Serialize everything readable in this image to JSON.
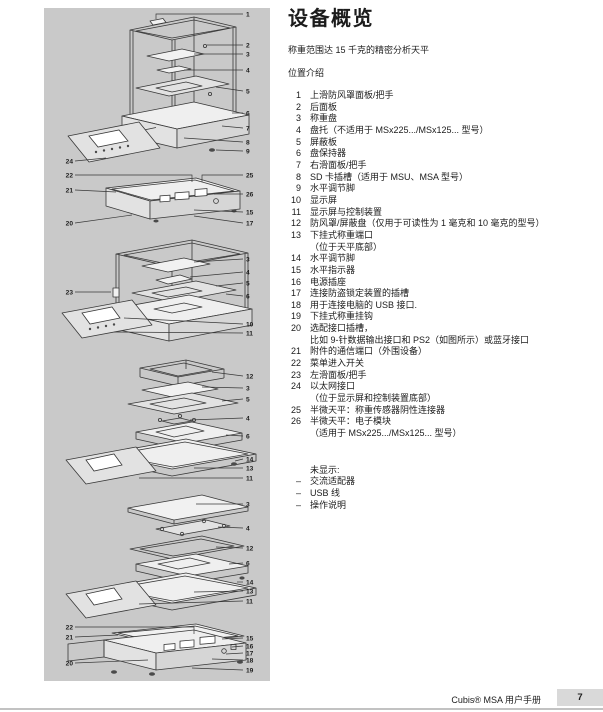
{
  "header": {
    "title": "设备概览",
    "subtitle": "称重范围达 15 千克的精密分析天平",
    "section_label": "位置介绍"
  },
  "parts_list": {
    "lines": [
      {
        "no": "1",
        "text": "上滑防风罩面板/把手"
      },
      {
        "no": "2",
        "text": "后面板"
      },
      {
        "no": "3",
        "text": "称重盘"
      },
      {
        "no": "4",
        "text": "盘托（不适用于 MSx225.../MSx125... 型号）"
      },
      {
        "no": "5",
        "text": "屏蔽板"
      },
      {
        "no": "6",
        "text": "盘保持器"
      },
      {
        "no": "7",
        "text": "右滑面板/把手"
      },
      {
        "no": "8",
        "text": "SD 卡插槽（适用于 MSU、MSA 型号）"
      },
      {
        "no": "9",
        "text": "水平调节脚"
      },
      {
        "no": "10",
        "text": "显示屏"
      },
      {
        "no": "11",
        "text": "显示屏与控制装置"
      },
      {
        "no": "12",
        "text": "防风罩/屏蔽盘（仅用于可读性为 1 毫克和 10 毫克的型号）"
      },
      {
        "no": "13",
        "text": "下挂式称重端口"
      },
      {
        "no": "",
        "text": "（位于天平底部）"
      },
      {
        "no": "14",
        "text": "水平调节脚"
      },
      {
        "no": "15",
        "text": "水平指示器"
      },
      {
        "no": "16",
        "text": "电源插座"
      },
      {
        "no": "17",
        "text": "连接防盗锁定装置的插槽"
      },
      {
        "no": "18",
        "text": "用于连接电脑的 USB 接口."
      },
      {
        "no": "19",
        "text": "下挂式称重挂钩"
      },
      {
        "no": "20",
        "text": "选配接口插槽，"
      },
      {
        "no": "",
        "text": "比如 9-针数据输出接口和 PS2（如图所示）或蓝牙接口"
      },
      {
        "no": "21",
        "text": "附件的通信端口（外围设备）"
      },
      {
        "no": "22",
        "text": "菜单进入开关"
      },
      {
        "no": "23",
        "text": "左滑面板/把手"
      },
      {
        "no": "24",
        "text": "以太网接口"
      },
      {
        "no": "",
        "text": "（位于显示屏和控制装置底部）"
      },
      {
        "no": "25",
        "text": "半微天平：称重传感器阴性连接器"
      },
      {
        "no": "26",
        "text": "半微天平：电子模块"
      },
      {
        "no": "",
        "text": "（适用于 MSx225.../MSx125... 型号）"
      }
    ]
  },
  "not_shown": {
    "lines": [
      {
        "no": "",
        "text": "未显示:"
      },
      {
        "no": "–",
        "text": "交流适配器"
      },
      {
        "no": "–",
        "text": "USB 线"
      },
      {
        "no": "–",
        "text": "操作说明"
      }
    ]
  },
  "footer": {
    "manual_title": "Cubis® MSA 用户手册",
    "page_number": "7"
  },
  "diagram": {
    "panel_color": "#c9c9c9",
    "figures": [
      {
        "name": "balance-with-draft-shield",
        "callouts": [
          "1",
          "2",
          "3",
          "4",
          "5",
          "6",
          "7",
          "8",
          "9",
          "24"
        ]
      },
      {
        "name": "electronics-module",
        "callouts": [
          "22",
          "25",
          "21",
          "26",
          "15",
          "20",
          "17"
        ]
      },
      {
        "name": "open-cage-balance",
        "callouts": [
          "3",
          "4",
          "5",
          "23",
          "6",
          "10",
          "11"
        ]
      },
      {
        "name": "exploded-shield-stack",
        "callouts": [
          "12",
          "3",
          "5",
          "4",
          "6",
          "14",
          "13",
          "11"
        ]
      },
      {
        "name": "exploded-pan-stack",
        "callouts": [
          "3",
          "4",
          "12",
          "6",
          "14",
          "13",
          "11"
        ]
      },
      {
        "name": "rear-connection-panel",
        "callouts": [
          "22",
          "21",
          "15",
          "16",
          "17",
          "20",
          "18",
          "19"
        ]
      }
    ]
  }
}
